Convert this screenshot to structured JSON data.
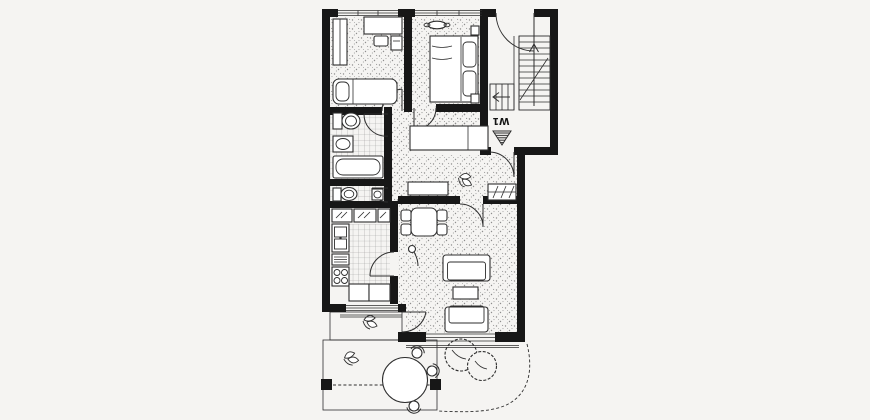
{
  "plan": {
    "entrance_label": "W1",
    "colors": {
      "background": "#f5f4f2",
      "paper": "#ffffff",
      "wall": "#171717",
      "line": "#2e2e2e",
      "stipple": "#8e8e8e",
      "tile": "#9b9b9b",
      "deck": "#7a7a7a"
    },
    "symbols": {
      "entrance_marker": "striped-triangle-down",
      "stair_direction": "arrow-up",
      "lower_stair_direction": "arrow-left"
    }
  }
}
